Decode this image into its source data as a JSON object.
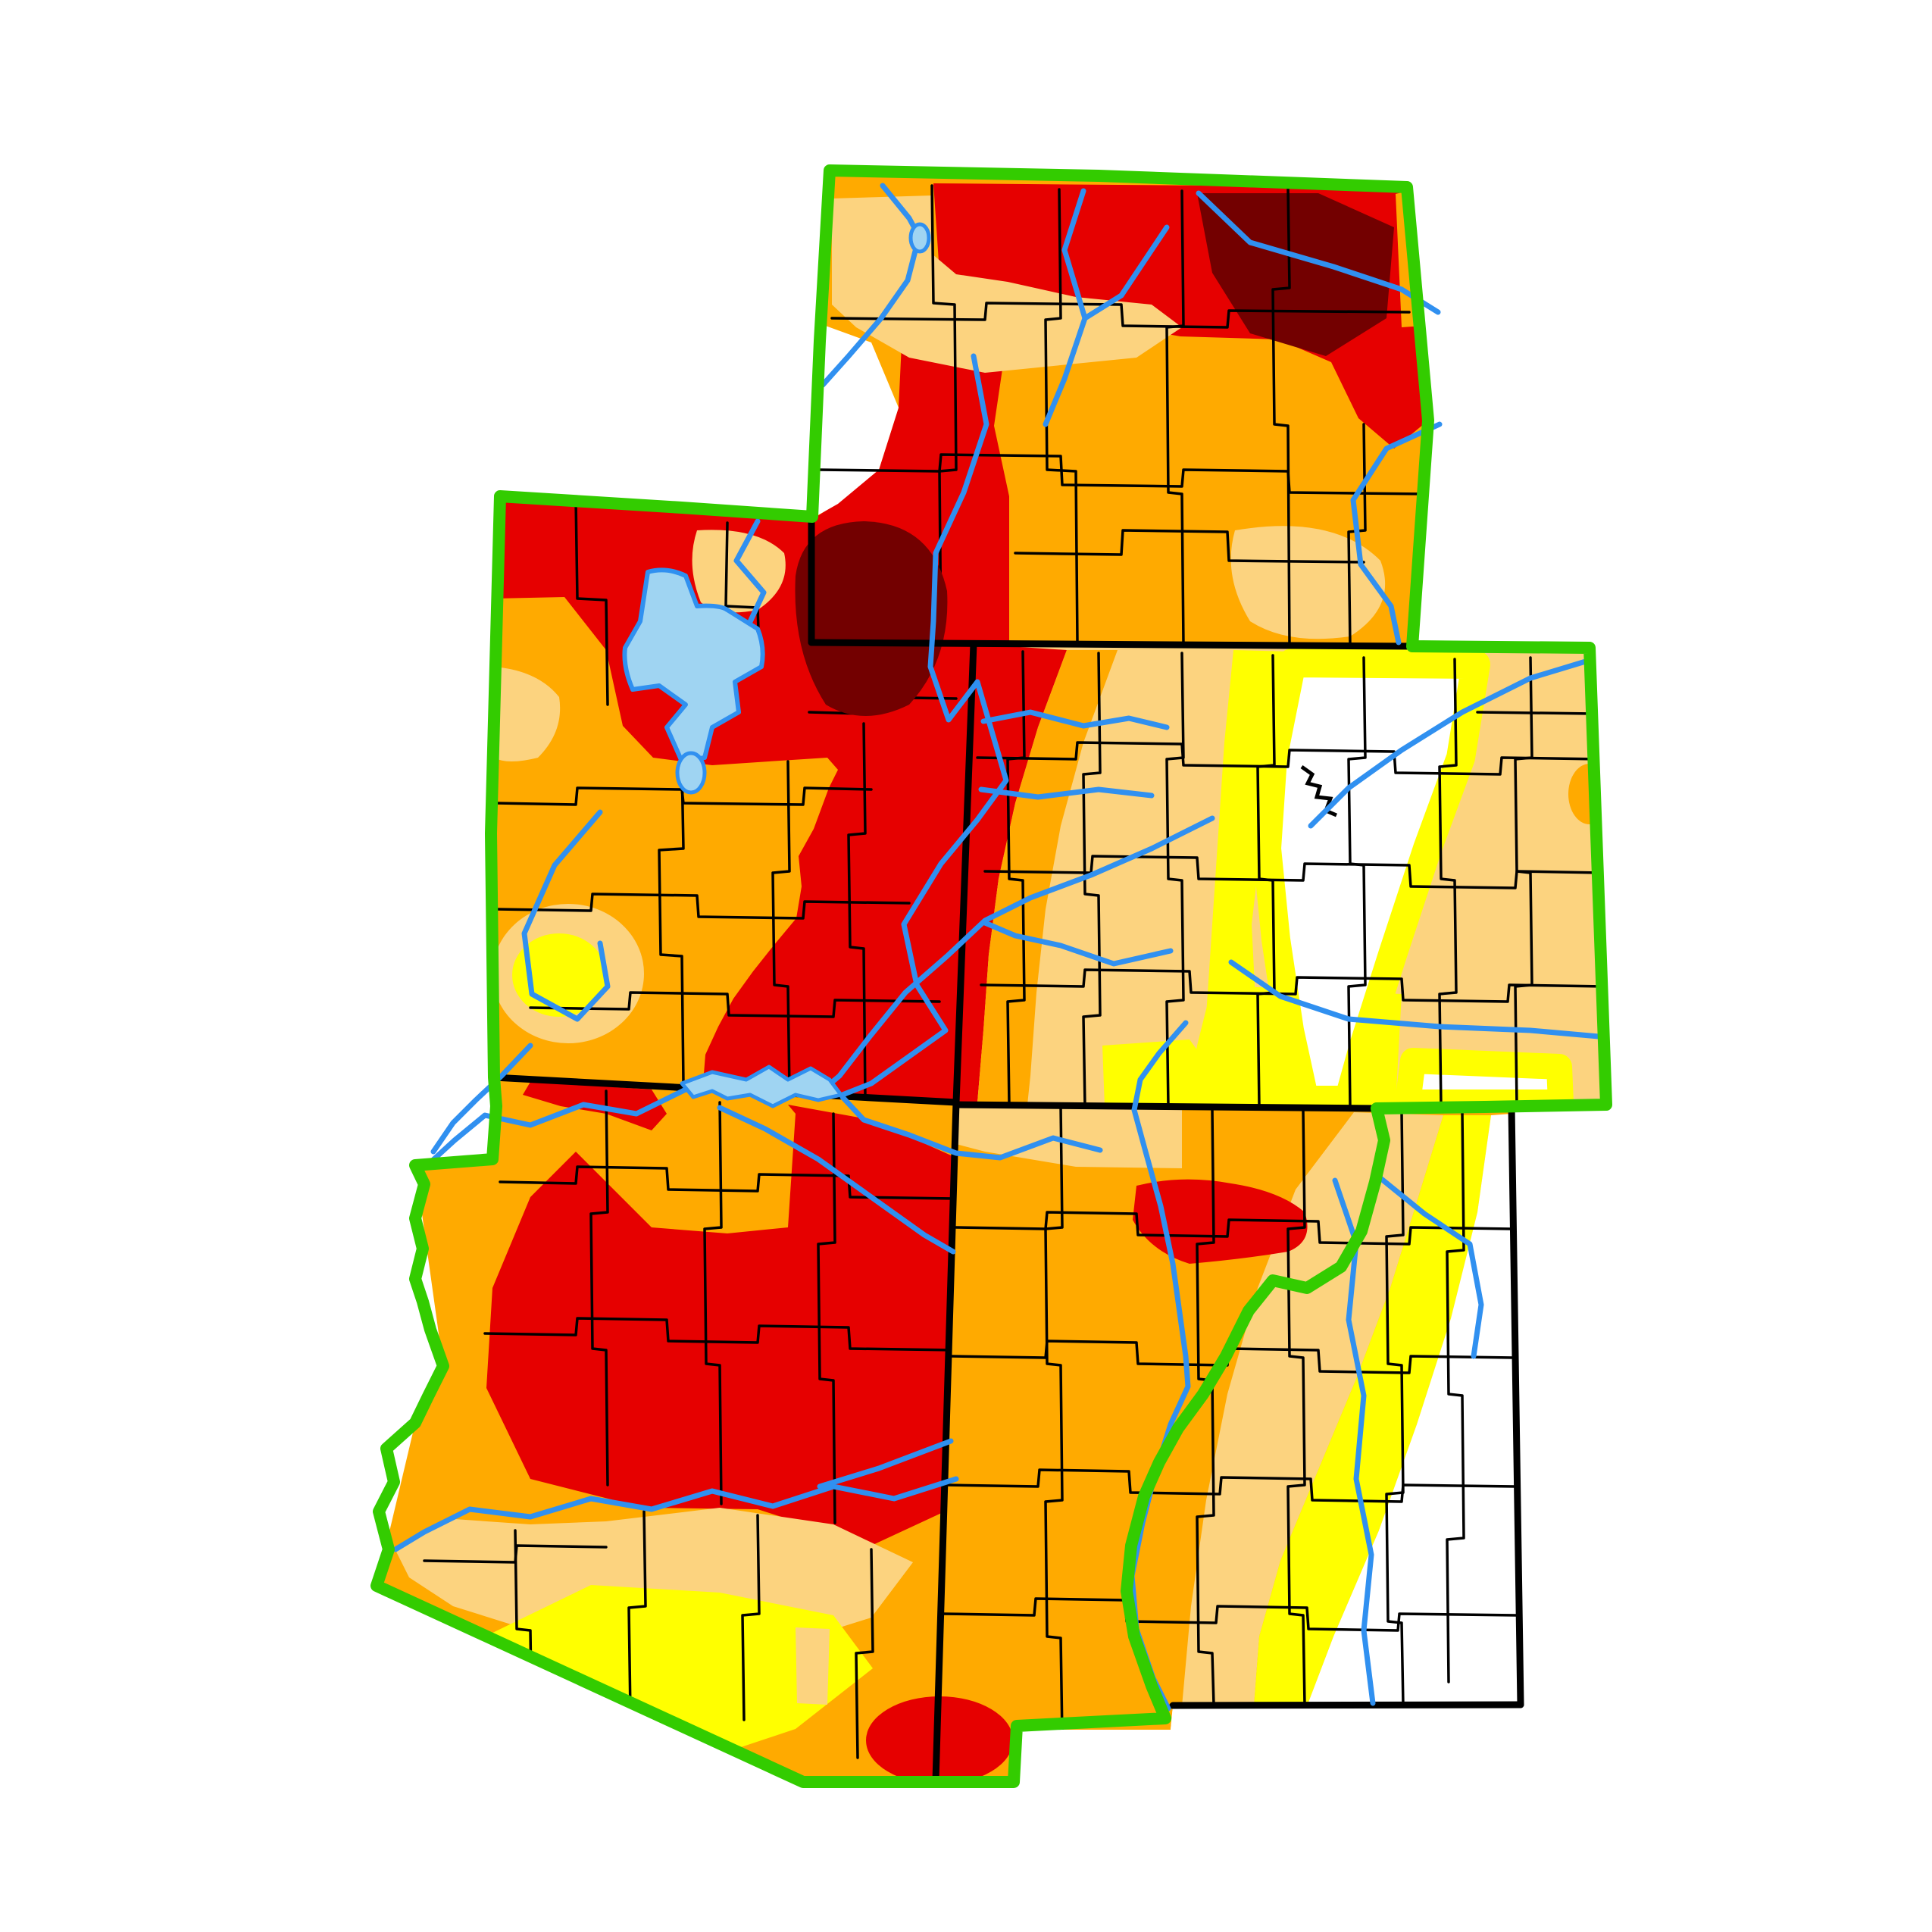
{
  "map": {
    "kind": "drought-monitor-choropleth",
    "background": "#FFFFFF"
  },
  "colors": {
    "none": "#FFFFFF",
    "d0": "#FFFF00",
    "d1": "#FCD37F",
    "d2": "#FFAA00",
    "d3": "#E60000",
    "d4": "#730000",
    "border": "#000000",
    "county": "#000000",
    "river": "#3090F0",
    "lake": "#9FD4F2",
    "region": "#33CC00"
  },
  "drought_legend": [
    {
      "code": "none",
      "label": "None",
      "color": "#FFFFFF"
    },
    {
      "code": "d0",
      "label": "D0 Abnormally Dry",
      "color": "#FFFF00"
    },
    {
      "code": "d1",
      "label": "D1 Moderate Drought",
      "color": "#FCD37F"
    },
    {
      "code": "d2",
      "label": "D2 Severe Drought",
      "color": "#FFAA00"
    },
    {
      "code": "d3",
      "label": "D3 Extreme Drought",
      "color": "#E60000"
    },
    {
      "code": "d4",
      "label": "D4 Exceptional Drought",
      "color": "#730000"
    }
  ],
  "states": [
    {
      "id": "wyoming"
    },
    {
      "id": "utah"
    },
    {
      "id": "colorado"
    },
    {
      "id": "arizona"
    },
    {
      "id": "new-mexico"
    }
  ]
}
